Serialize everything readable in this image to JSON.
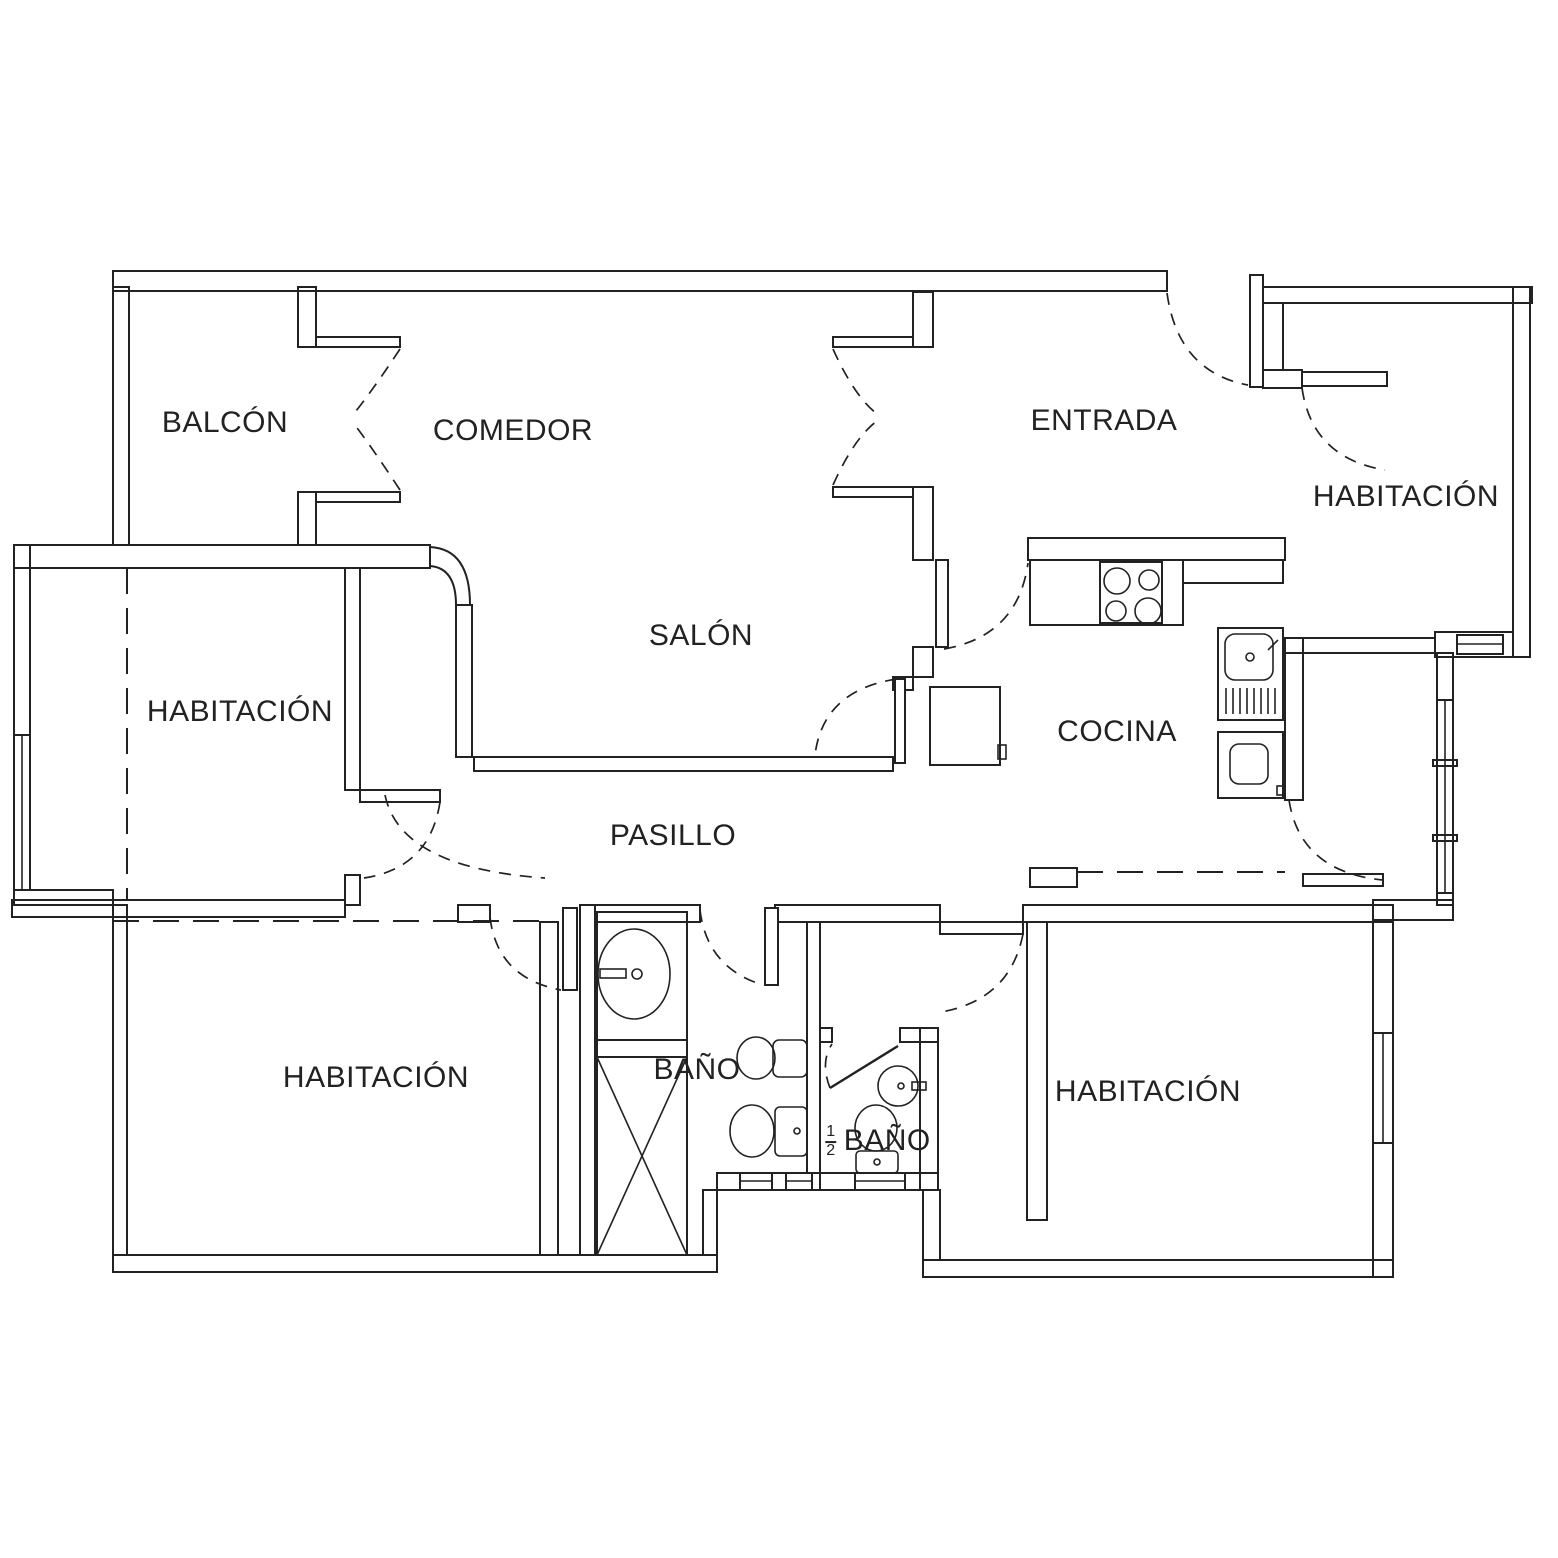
{
  "document": {
    "type": "apartment-floor-plan",
    "style": "CAD black-line drawing on white"
  },
  "colors": {
    "line": "#222222",
    "background": "#ffffff"
  },
  "rooms": [
    {
      "id": "balcon",
      "label": "BALCÓN"
    },
    {
      "id": "comedor",
      "label": "COMEDOR"
    },
    {
      "id": "entrada",
      "label": "ENTRADA"
    },
    {
      "id": "habitacion-noreste",
      "label": "HABITACIÓN"
    },
    {
      "id": "salon",
      "label": "SALÓN"
    },
    {
      "id": "habitacion-oeste",
      "label": "HABITACIÓN"
    },
    {
      "id": "cocina",
      "label": "COCINA"
    },
    {
      "id": "pasillo",
      "label": "PASILLO"
    },
    {
      "id": "habitacion-suroeste",
      "label": "HABITACIÓN"
    },
    {
      "id": "bano",
      "label": "BAÑO"
    },
    {
      "id": "medio-bano",
      "label": "BAÑO",
      "prefix_numerator": "1",
      "prefix_denominator": "2"
    },
    {
      "id": "habitacion-sureste",
      "label": "HABITACIÓN"
    }
  ],
  "fixtures": [
    "stove-4-burners",
    "kitchen-counter",
    "kitchen-sink-with-drainboard",
    "washing-machine",
    "water-heater",
    "shower-tray",
    "bathroom-vanity-sink",
    "bidet",
    "toilet",
    "half-bath-round-sink",
    "half-bath-toilet"
  ],
  "openings": [
    "balcony-french-doors",
    "comedor-entrada-double-doors",
    "front-door",
    "bedroom-ne-door",
    "salon-east-door",
    "salon-pasillo-door",
    "bedroom-west-door",
    "bedroom-sw-door",
    "bathroom-door",
    "half-bath-door",
    "kitchen-door",
    "bedroom-se-door"
  ],
  "windows": [
    "bedroom-west-window",
    "kitchen-east-window",
    "bedroom-se-east-window",
    "bathroom-south-windows",
    "half-bath-south-window",
    "bedroom-ne-south-window"
  ]
}
